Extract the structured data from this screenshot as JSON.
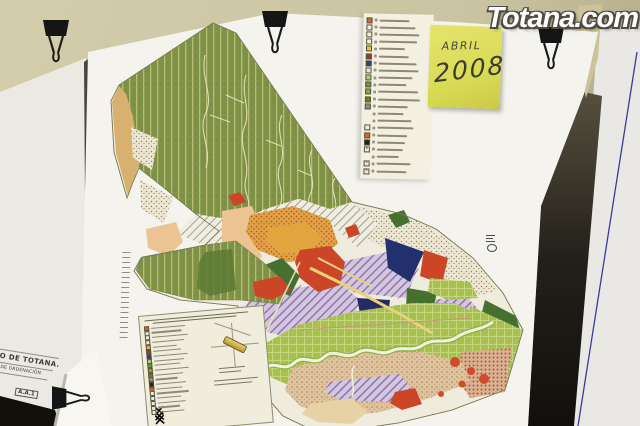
{
  "watermark": {
    "text": "Totana.com"
  },
  "sticky_note": {
    "line1": "ABRIL",
    "line2": "2008",
    "color": "#dadb55"
  },
  "back_sheet": {
    "line1": "TO DE TOTANA.",
    "line2": "AL DE ORDENACIÓN",
    "code": "A.A.1"
  },
  "legend_top": {
    "rows": [
      {
        "color": "#c96a2f",
        "w": 30
      },
      {
        "color": "#f2edda",
        "w": 36
      },
      {
        "color": "#f2edda",
        "w": 40
      },
      {
        "color": "#f2edda",
        "w": 38
      },
      {
        "color": "#e6c23c",
        "w": 26
      },
      {
        "color": "#9c3a24",
        "w": 30
      },
      {
        "color": "#24407e",
        "w": 38
      },
      {
        "color": "#eae6d2",
        "w": 40
      },
      {
        "color": "#b7c98a",
        "w": 34
      },
      {
        "color": "#679a41",
        "w": 28
      },
      {
        "color": "#93a233",
        "w": 40
      },
      {
        "color": "#6f7d23",
        "w": 42
      },
      {
        "color": "#8f9181",
        "w": 30
      },
      {
        "color": "",
        "w": 26
      },
      {
        "color": "",
        "w": 34
      },
      {
        "color": "#f2edda",
        "w": 36
      },
      {
        "color": "#cf6a2c",
        "w": 30
      },
      {
        "color": "#20201e",
        "w": 28
      },
      {
        "color": "#f2edda",
        "w": 26,
        "x": true
      },
      {
        "color": "",
        "w": 22
      },
      {
        "color": "#f2edda",
        "w": 34,
        "x": true
      },
      {
        "color": "#f2edda",
        "w": 30,
        "x": true
      }
    ]
  },
  "inset_legend": {
    "rows": [
      {
        "color": "#c96a2f",
        "w": 34
      },
      {
        "color": "#f2edda",
        "w": 30
      },
      {
        "color": "#f2edda",
        "w": 36
      },
      {
        "color": "#f2edda",
        "w": 32
      },
      {
        "color": "#e6c23c",
        "w": 24
      },
      {
        "color": "#9c3a24",
        "w": 28
      },
      {
        "color": "#24407e",
        "w": 34
      },
      {
        "color": "#b7c98a",
        "w": 30
      },
      {
        "color": "#679a41",
        "w": 26
      },
      {
        "color": "#93a233",
        "w": 34
      },
      {
        "color": "#6f7d23",
        "w": 28
      },
      {
        "color": "#8f9181",
        "w": 22
      },
      {
        "color": "#20201e",
        "w": 30
      },
      {
        "color": "#cf6a2c",
        "w": 26
      },
      {
        "color": "#f2edda",
        "w": 32
      },
      {
        "color": "#f2edda",
        "w": 24
      },
      {
        "color": "#f2edda",
        "w": 28,
        "x": true
      },
      {
        "color": "#f2edda",
        "w": 22,
        "x": true
      },
      {
        "color": "#f2edda",
        "w": 26,
        "x": true
      }
    ]
  },
  "palette": {
    "wall": "#cdc7a5",
    "sheet_white": "#f4f3ee",
    "mountain_green": "#7e9046",
    "valley_lime": "#a9c050",
    "urban_orange": "#e2a24a",
    "town_red": "#cd4527",
    "navy": "#22306e",
    "lilac_hatch": "#cfc2da",
    "tan_wedge": "#d8b170",
    "south_tan": "#dec49e",
    "river": "#f3f0dd",
    "note_yellow": "#dadb55",
    "margin_line_blue": "#3b3b99",
    "clip_black": "#151515"
  }
}
